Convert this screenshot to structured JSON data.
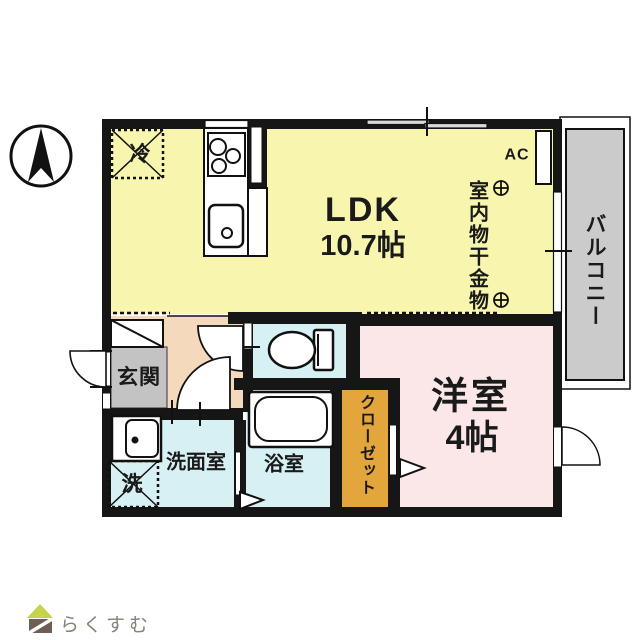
{
  "plan": {
    "rooms": {
      "ldk": {
        "label": "LDK",
        "size": "10.7帖"
      },
      "western_room": {
        "label": "洋室",
        "size": "4帖"
      },
      "entrance": {
        "label": "玄関"
      },
      "washroom": {
        "label": "洗面室"
      },
      "bathroom": {
        "label": "浴室"
      },
      "closet": {
        "label": "クローゼット"
      },
      "balcony": {
        "label": "バルコニー"
      }
    },
    "annotations": {
      "laundry_hardware": "室内物干金物",
      "air_conditioner": "AC",
      "refrigerator_space": "冷",
      "washer_space": "洗"
    },
    "colors": {
      "ldk_fill": "#f8f6ae",
      "western_room_fill": "#fbe7e7",
      "wet_area_fill": "#d6f0f3",
      "hallway_fill": "#f5d9bc",
      "entrance_fill": "#c3c3c3",
      "balcony_fill": "#cbcbcb",
      "closet_fill": "#e2a63d",
      "wall": "#161616"
    }
  },
  "branding": {
    "logo_text": "らくすむ",
    "logo_roof_color": "#c6d248",
    "logo_body_color": "#6d5f53",
    "logo_text_color": "#8b8277"
  }
}
